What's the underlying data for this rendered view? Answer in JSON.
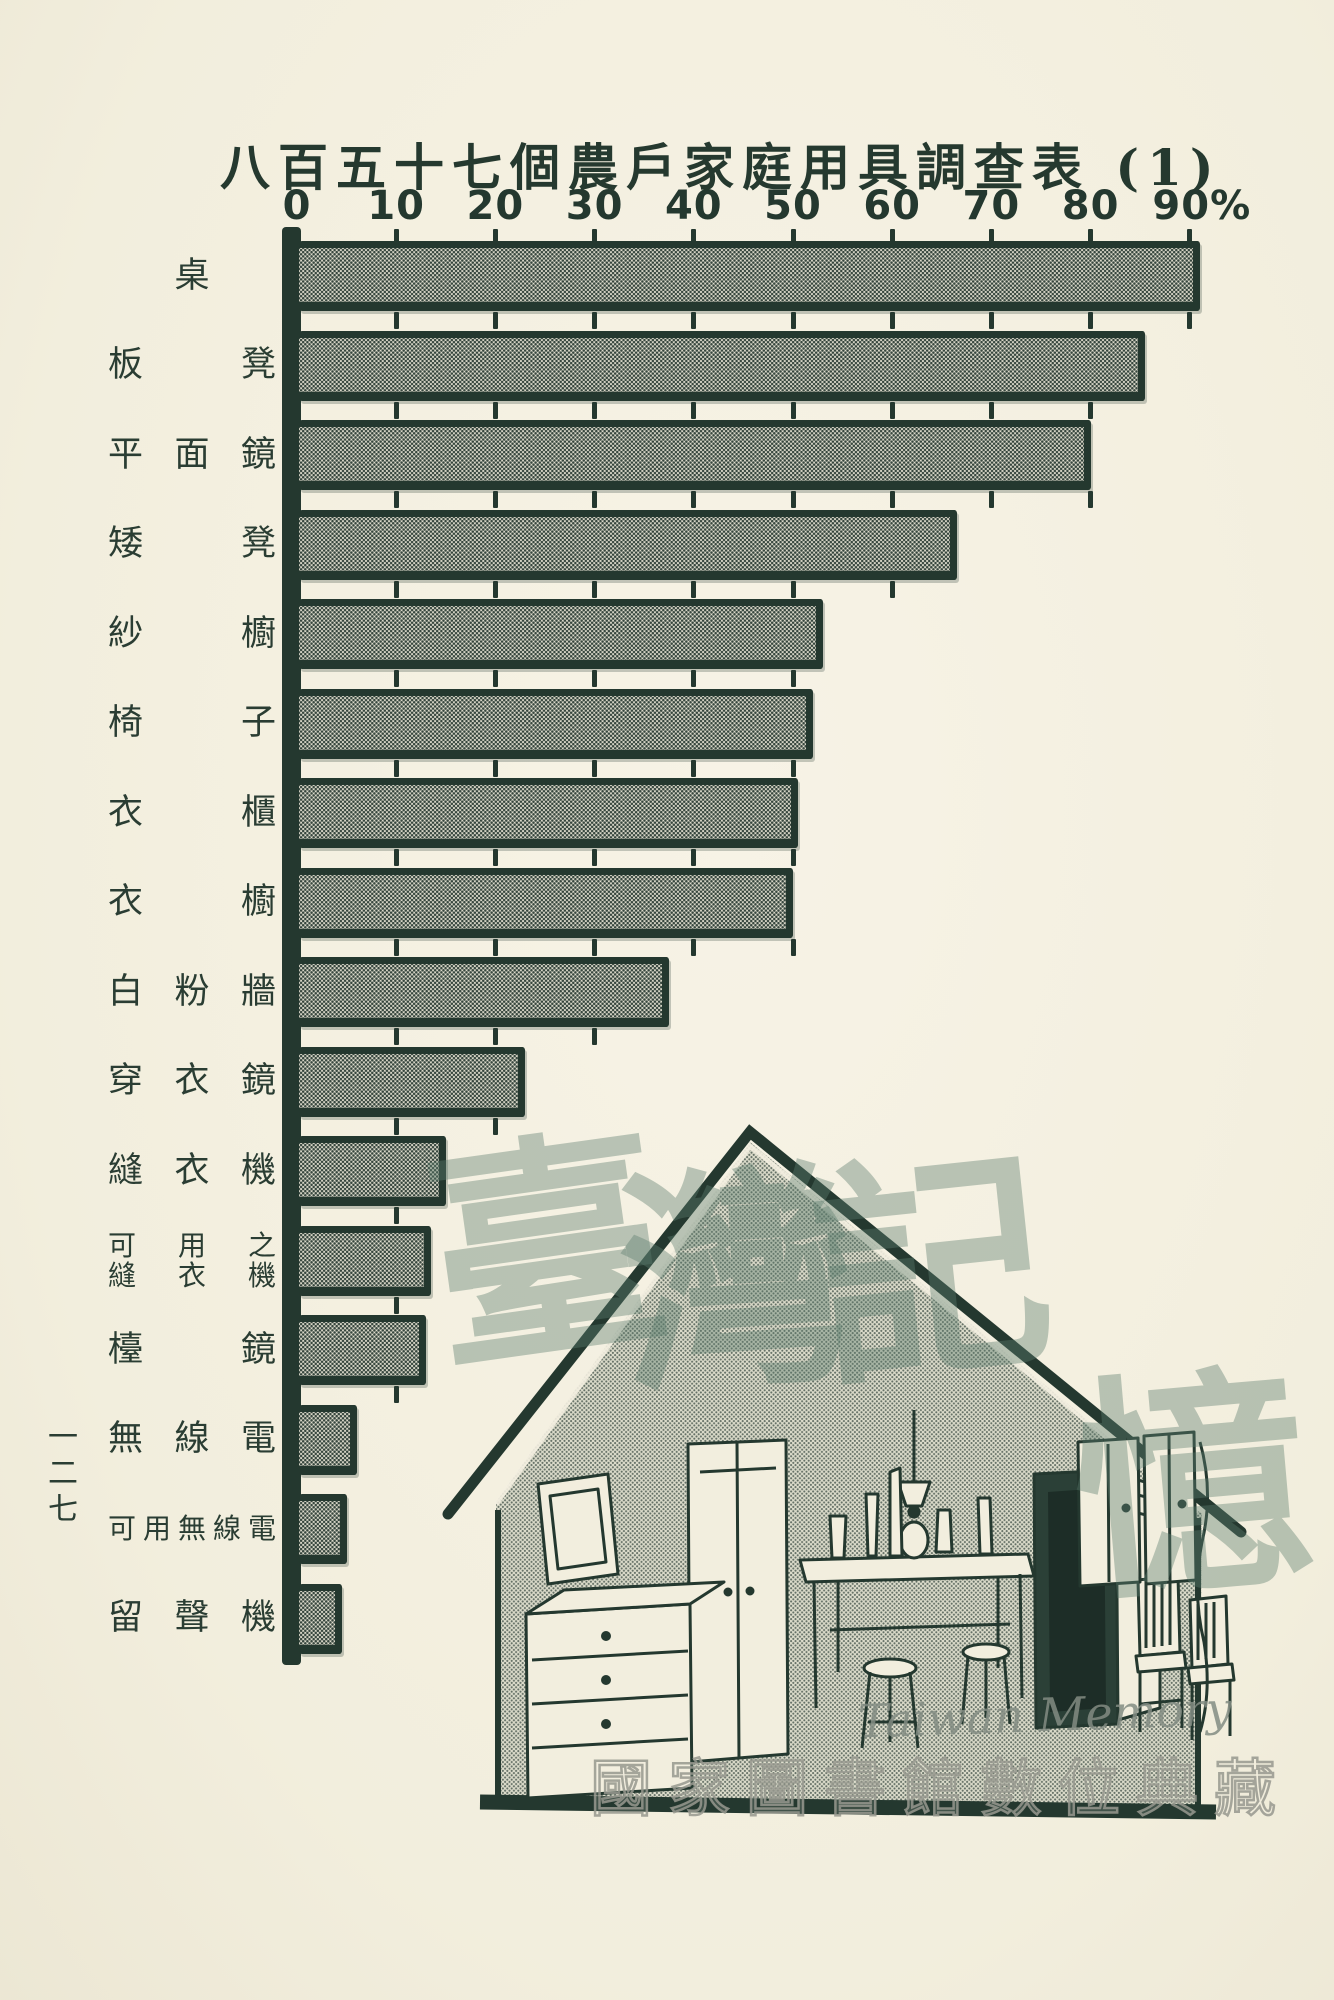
{
  "colors": {
    "paper": "#f4f0e1",
    "ink": "#24382f",
    "bar_fill_base": "#e4e1d2",
    "watermark_green": "#5d7d6f",
    "watermark_gray": "#96988e"
  },
  "page": {
    "page_number_vertical": "一二七",
    "page_number_chars": [
      "一",
      "二",
      "七"
    ]
  },
  "chart_data": {
    "type": "bar",
    "orientation": "horizontal",
    "title": "八百五十七個農戶家庭用具調查表 (1)",
    "xlabel": "",
    "ylabel": "",
    "x_axis": {
      "min": 0,
      "max": 90,
      "tick_interval": 10,
      "tick_labels": [
        "0",
        "10",
        "20",
        "30",
        "40",
        "50",
        "60",
        "70",
        "80",
        "90%"
      ],
      "unit": "%"
    },
    "legend": null,
    "grid": "short tick stubs repeated between bars",
    "bars": [
      {
        "label": "桌",
        "value": 91
      },
      {
        "label": "板凳",
        "value": 85.5
      },
      {
        "label": "平面鏡",
        "value": 80
      },
      {
        "label": "矮凳",
        "value": 66.5
      },
      {
        "label": "紗櫥",
        "value": 53
      },
      {
        "label": "椅子",
        "value": 52
      },
      {
        "label": "衣櫃",
        "value": 50.5
      },
      {
        "label": "衣櫥",
        "value": 50
      },
      {
        "label": "白粉牆",
        "value": 37.5
      },
      {
        "label": "穿衣鏡",
        "value": 23
      },
      {
        "label": "縫衣機",
        "value": 15
      },
      {
        "label": "可用之縫衣機",
        "value": 13.5,
        "display_lines": [
          "可用之",
          "縫衣機"
        ]
      },
      {
        "label": "檯鏡",
        "value": 13
      },
      {
        "label": "無線電",
        "value": 6
      },
      {
        "label": "可用無線電",
        "value": 5
      },
      {
        "label": "留聲機",
        "value": 4.5
      }
    ]
  },
  "watermark": {
    "calligraphy_text": "臺灣記憶",
    "calligraphy_chars": [
      "臺",
      "灣",
      "記",
      "憶"
    ],
    "latin_text": "Taiwan Memory",
    "institution_text": "國家圖書館數位典藏"
  },
  "illustration": {
    "name": "farmhouse-interior-line-drawing"
  }
}
